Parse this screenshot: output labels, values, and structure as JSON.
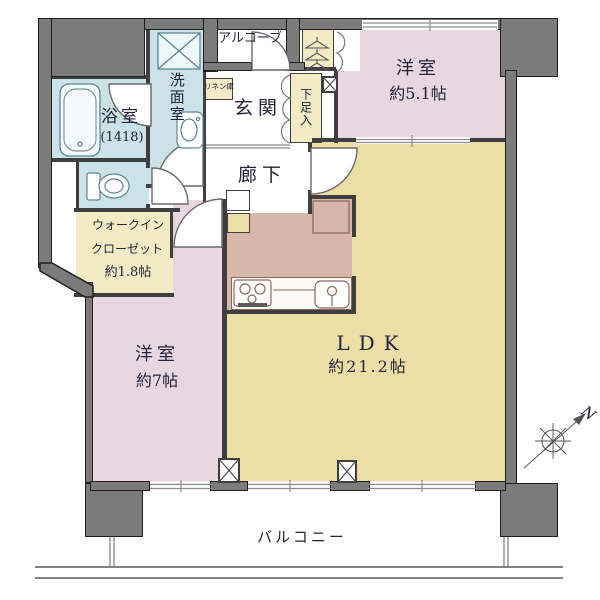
{
  "floorplan": {
    "rooms": {
      "bathroom": {
        "label": "浴室",
        "dimension": "(1418)"
      },
      "washroom": {
        "label": "洗面室"
      },
      "linen_cabinet": {
        "label": "リネン庫"
      },
      "alcove": {
        "label": "アルコーブ"
      },
      "entrance": {
        "label": "玄関"
      },
      "shoe_cabinet": {
        "label": "下足入"
      },
      "corridor": {
        "label": "廊下"
      },
      "bedroom_51": {
        "label": "洋室",
        "size": "約5.1帖"
      },
      "bedroom_7": {
        "label": "洋室",
        "size": "約7帖"
      },
      "walk_in_closet": {
        "label_line1": "ウォークイン",
        "label_line2": "クローゼット",
        "size": "約1.8帖"
      },
      "ldk": {
        "label": "LDK",
        "size": "約21.2帖"
      },
      "balcony": {
        "label": "バルコニー"
      }
    },
    "compass": {
      "north_label": "N"
    },
    "colors": {
      "wall_gray": "#7b7b7b",
      "wall_line": "#3f3f3f",
      "bedroom_pink": "#e8d7e0",
      "ldk_yellow": "#ecdfa6",
      "kitchen_brown": "#d6b7a9",
      "wet_area_blue": "#cbe2e7",
      "closet_cream": "#f2ebc4",
      "fixture_blue_line": "#5b8796",
      "fixture_brown_line": "#8a675a"
    }
  }
}
